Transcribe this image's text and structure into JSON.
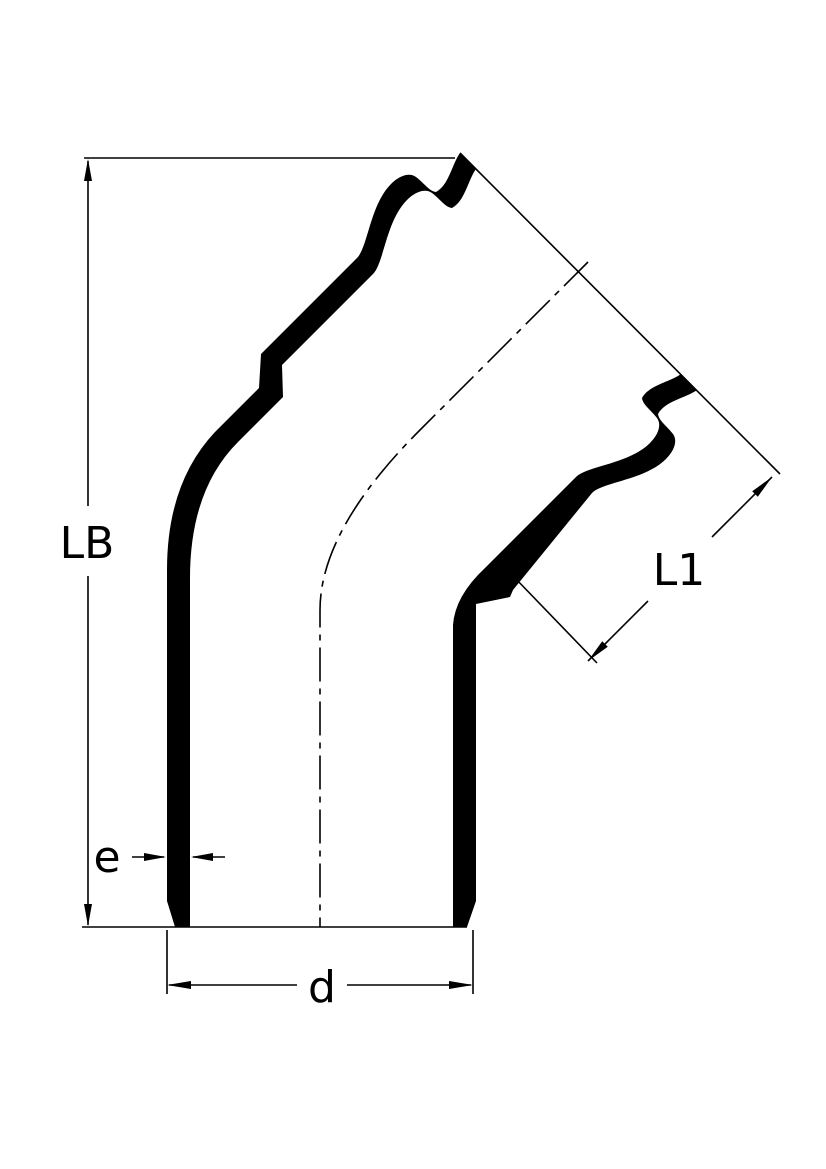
{
  "drawing": {
    "type": "technical-dimension-drawing",
    "subject": "45-degree pipe elbow cross-section, socket end upper right, spigot end bottom",
    "colors": {
      "line": "#000000",
      "background": "#ffffff"
    },
    "labels": {
      "lb": "LB",
      "l1": "L1",
      "e": "e",
      "d": "d"
    },
    "dimension_meanings": {
      "lb": "overall height from bottom spigot plane to socket mouth plane",
      "l1": "socket insertion depth along 45-degree branch axis",
      "e": "pipe wall thickness",
      "d": "outer diameter at bottom spigot end"
    }
  }
}
